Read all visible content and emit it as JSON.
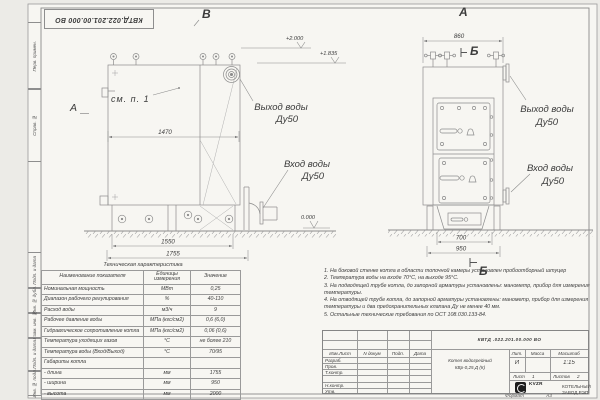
{
  "sheet": {
    "doc_number_top": "КВТД.022.201.00.000 ВО",
    "format_label": "Формат",
    "format_value": "А3"
  },
  "margin_labels": {
    "perv_primen": "Перв. примен.",
    "sprav_no": "Справ. №",
    "podp_data_1": "Подп. и дата",
    "inv_dubl": "Инв. № дубл.",
    "vzam_inv": "Взам. инв. №",
    "podp_data_2": "Подп. и дата",
    "inv_podl": "Инв. № подл."
  },
  "views": {
    "view_b_label": "В",
    "view_a_label": "А",
    "section_b_top": "Б",
    "section_b_bottom": "Б",
    "section_a_label": "А",
    "see_note": "см. п. 1",
    "dims": {
      "d1470": "1470",
      "d1550": "1550",
      "d1755": "1755",
      "d860": "860",
      "d700": "700",
      "d950": "950"
    },
    "elevations": {
      "e2000": "+2.000",
      "e1835": "+1.835",
      "e0": "0.000"
    },
    "labels": {
      "outlet": "Выход воды",
      "inlet": "Вход воды",
      "dn50": "Ду50"
    }
  },
  "tech_table": {
    "title": "Техническая характеристика",
    "headers": [
      "Наименование показателя",
      "Единицы измерения",
      "Значение"
    ],
    "rows": [
      {
        "name": "Номинальная мощность",
        "unit": "МВт",
        "value": "0,25"
      },
      {
        "name": "Диапазон рабочего регулирования",
        "unit": "%",
        "value": "40-110"
      },
      {
        "name": "Расход воды",
        "unit": "м3/ч",
        "value": "9"
      },
      {
        "name": "Рабочее давление воды",
        "unit": "МПа (кгс/см2)",
        "value": "0,6 (6,0)"
      },
      {
        "name": "Гидравлическое сопротивление котла",
        "unit": "МПа (кгс/см2)",
        "value": "0,06 (0,6)"
      },
      {
        "name": "Температура уходящих газов",
        "unit": "°С",
        "value": "не более 210"
      },
      {
        "name": "Температура воды (Вход/Выход)",
        "unit": "°С",
        "value": "70/95"
      },
      {
        "name": "Габариты котла",
        "unit": "",
        "value": ""
      },
      {
        "name": "  - длина",
        "unit": "мм",
        "value": "1755"
      },
      {
        "name": "  - ширина",
        "unit": "мм",
        "value": "950"
      },
      {
        "name": "  - высота",
        "unit": "мм",
        "value": "2000"
      }
    ]
  },
  "notes": {
    "items": [
      "1.  На боковой стенке котла в области топочной камеры установлен пробоотборный штуцер",
      "2.  Температура воды на входе 70°С, на выходе 95°С.",
      "3.  На подводящей трубе котла, до запорной арматуры установлены: манометр, прибор для измерения температуры.",
      "4.  На отводящей трубе котла, до запорной арматуры установлены: манометр, прибор для измерения температуры и два предохранительных клапана Ду не менее 40 мм.",
      "5.  Остальные технические требования по ОСТ 108.030.133-84."
    ]
  },
  "title_block": {
    "designation": "КВТД .022.201.00.000  ВО",
    "product_name_line1": "Котел водогрейный",
    "product_name_line2": "КВр-0,25  Д  (К)",
    "headers": {
      "izm_list": "Изм.Лист",
      "ndoc": "N докум",
      "podp": "Подп.",
      "data": "Дата",
      "lit": "Лит.",
      "massa": "Масса",
      "scale": "Масштаб"
    },
    "rows": {
      "razrab": "Разраб.",
      "prov": "Пров.",
      "tkontr": "Т.контр.",
      "nkontr": "Н.контр.",
      "utv": "Утв."
    },
    "lit_value": "И",
    "scale_value": "1:15",
    "sheet_row": {
      "sheet_label": "Лист",
      "sheet_value": "1",
      "sheets_label": "Листов",
      "sheets_value": "2"
    },
    "logo": {
      "text": "KVZR",
      "sub1": "КОТЕЛЬНЫЙ",
      "sub2": "ЗАВОД РЭП"
    }
  }
}
